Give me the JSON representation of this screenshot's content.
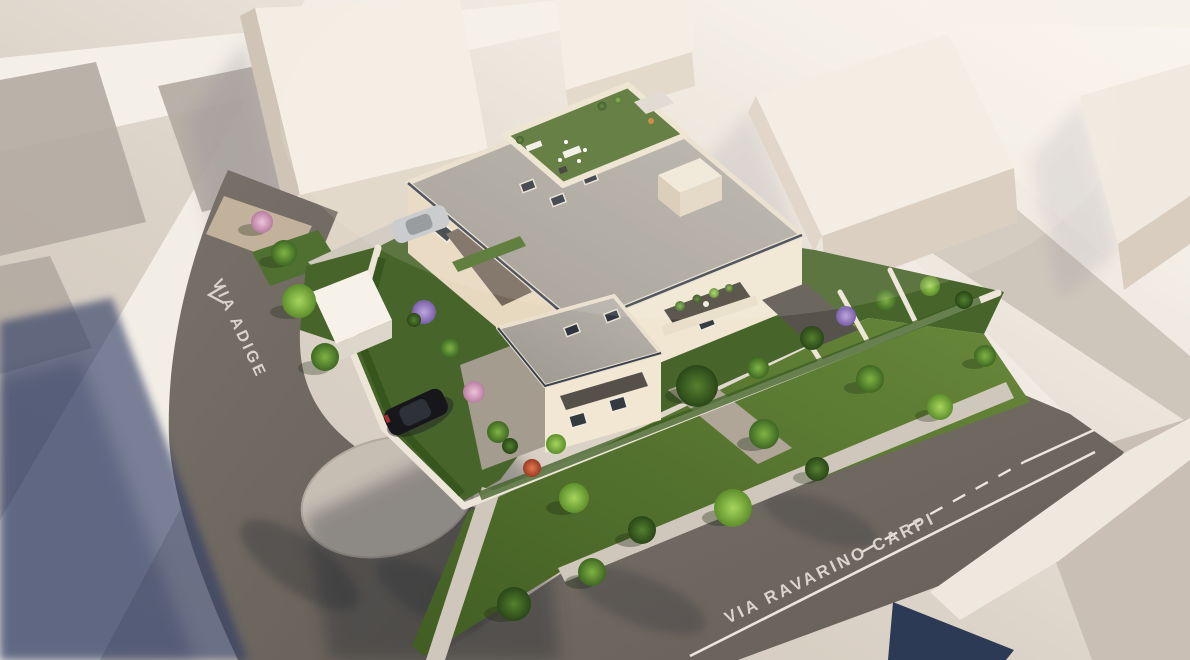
{
  "scene": {
    "type": "3D aerial architectural rendering",
    "description": "Aerial render of a new residential building with roof garden terrace, private gardens, perimeter walls, parked cars and surrounding streets and neighbouring massing volumes",
    "labels": {
      "street_left": "VIA ADIGE",
      "street_bottom": "VIA RAVARINO CARPI"
    },
    "colors": {
      "ground_light": "#f6f1e9",
      "ground_base": "#d9d0c5",
      "block_gray": "#b2a9a0",
      "asphalt": "#6f6962",
      "asphalt_shadow_blue": "#2e3c66",
      "island": "#c6bdb3",
      "sidewalk": "#d2cabf",
      "lawn": "#567733",
      "garden": "#47652a",
      "tree_bright": "#8fc04a",
      "tree_mid": "#679c38",
      "tree_dark": "#3c5e22",
      "bloom_pink": "#dba8c6",
      "bloom_purple": "#9d83c8",
      "bloom_red": "#c2532f",
      "building_wall": "#f0e6d2",
      "building_wall_shade": "#e3d6bd",
      "roof": "#aba69e",
      "roof_trim": "#39404e",
      "terrace_lawn": "#51702e",
      "awning": "#57524b",
      "canopy": "#75675a",
      "perimeter_wall": "#ece5d8",
      "massing_top": "#f3ede3",
      "massing_front": "#dfd5c7",
      "massing_side": "#cfc4b6",
      "marking_white": "#eae5dd",
      "car_black": "#17171b",
      "car_silver": "#c3c6ca",
      "navy_roof": "#2c3a55"
    },
    "road_markings": [
      "solid edge line",
      "dashed center line",
      "lane arrow"
    ],
    "vehicles": [
      {
        "name": "black car driving on street"
      },
      {
        "name": "silver car parked at driveway"
      }
    ],
    "roof_terrace_items": [
      "synthetic lawn",
      "outdoor kitchen",
      "dining table with chairs",
      "shade sail",
      "sun lounger",
      "planters",
      "fire pit"
    ]
  }
}
